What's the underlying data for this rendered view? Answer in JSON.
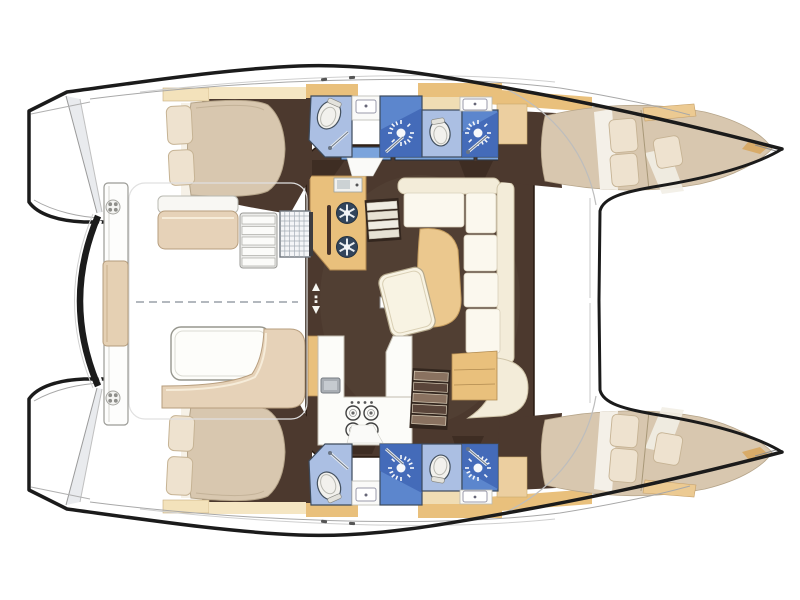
{
  "canvas": {
    "width": 800,
    "height": 600,
    "background": "#ffffff"
  },
  "diagram": {
    "type": "boat-floor-plan",
    "vessel": "sailing catamaran",
    "view": "overhead interior accommodation plan, bows pointing right",
    "hulls": [
      {
        "id": "upper-hull",
        "rooms": [
          "aft double cabin with pillows",
          "aft bathroom with toilet and shower",
          "forward bathroom with toilet and shower",
          "forward double berth in bow"
        ]
      },
      {
        "id": "lower-hull",
        "rooms": [
          "aft double cabin with pillows",
          "aft bathroom with toilet and shower",
          "forward bathroom with toilet and shower",
          "forward double berth in bow"
        ]
      }
    ],
    "bridgedeck": {
      "rooms": [
        "salon with L-shaped sofa, chaise and cocktail table",
        "galley block with two-burner stove and oven",
        "galley counter with four-burner stove and sink"
      ],
      "stairways_to_hulls": 2,
      "window_panes": 3
    },
    "cockpit": {
      "features": [
        "bench seat with cushion",
        "side steps",
        "vented locker grate",
        "dining table",
        "L-shaped bench",
        "aft crossbeam arch",
        "transom plank with center cushion",
        "two deck cleat rosettes",
        "dashed centerline"
      ]
    },
    "fixture_counts": {
      "toilets": 4,
      "shower_heads": 4,
      "sinks": 4,
      "double_beds": 4,
      "salon_burners": 2,
      "galley_burners": 4
    }
  },
  "palette": {
    "outline": "#1b1b1b",
    "floor": "#4c392e",
    "floor_light": "#59463a",
    "wood": "#e9c07c",
    "wood_pale": "#f3e2bb",
    "wood_soft": "#eccfa0",
    "sofa_cream": "#f3ecd9",
    "cushion_white": "#fbf8ee",
    "mattress": "#d8c7af",
    "pillow": "#eee2cf",
    "cushion_tan": "#e6d2b8",
    "bath_light": "#abbfe3",
    "bath_medium": "#5c86cd",
    "bath_dark": "#3f66b5",
    "window_blue": "#7ba4dc",
    "detail_grey": "#9aa0a8",
    "deck_white": "#ffffff"
  }
}
